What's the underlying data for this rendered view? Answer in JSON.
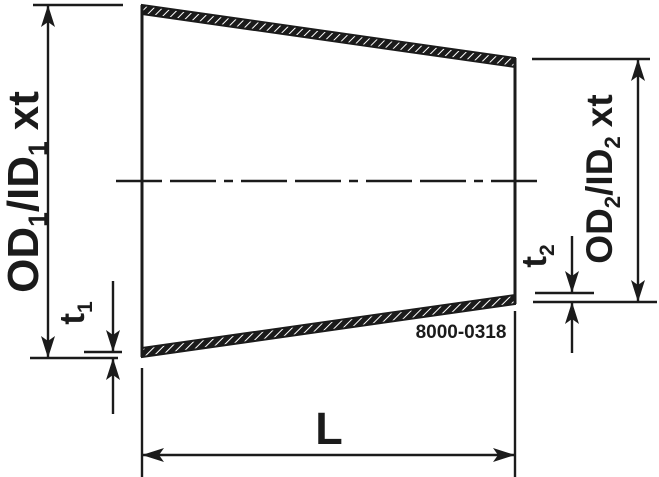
{
  "diagram": {
    "type": "technical-drawing",
    "subject": "concentric-reducer-section-view",
    "part_number": "8000-0318",
    "labels": {
      "od1": {
        "main": "OD",
        "sub1": "1",
        "mid": "/ID",
        "sub2": "1",
        "suffix": "xt"
      },
      "od2": {
        "main": "OD",
        "sub1": "2",
        "mid": "/ID",
        "sub2": "2",
        "suffix": "xt"
      },
      "t1": {
        "main": "t",
        "sub": "1"
      },
      "t2": {
        "main": "t",
        "sub": "2"
      },
      "length": "L"
    },
    "colors": {
      "line": "#1b1b1b",
      "background": "#ffffff"
    }
  }
}
